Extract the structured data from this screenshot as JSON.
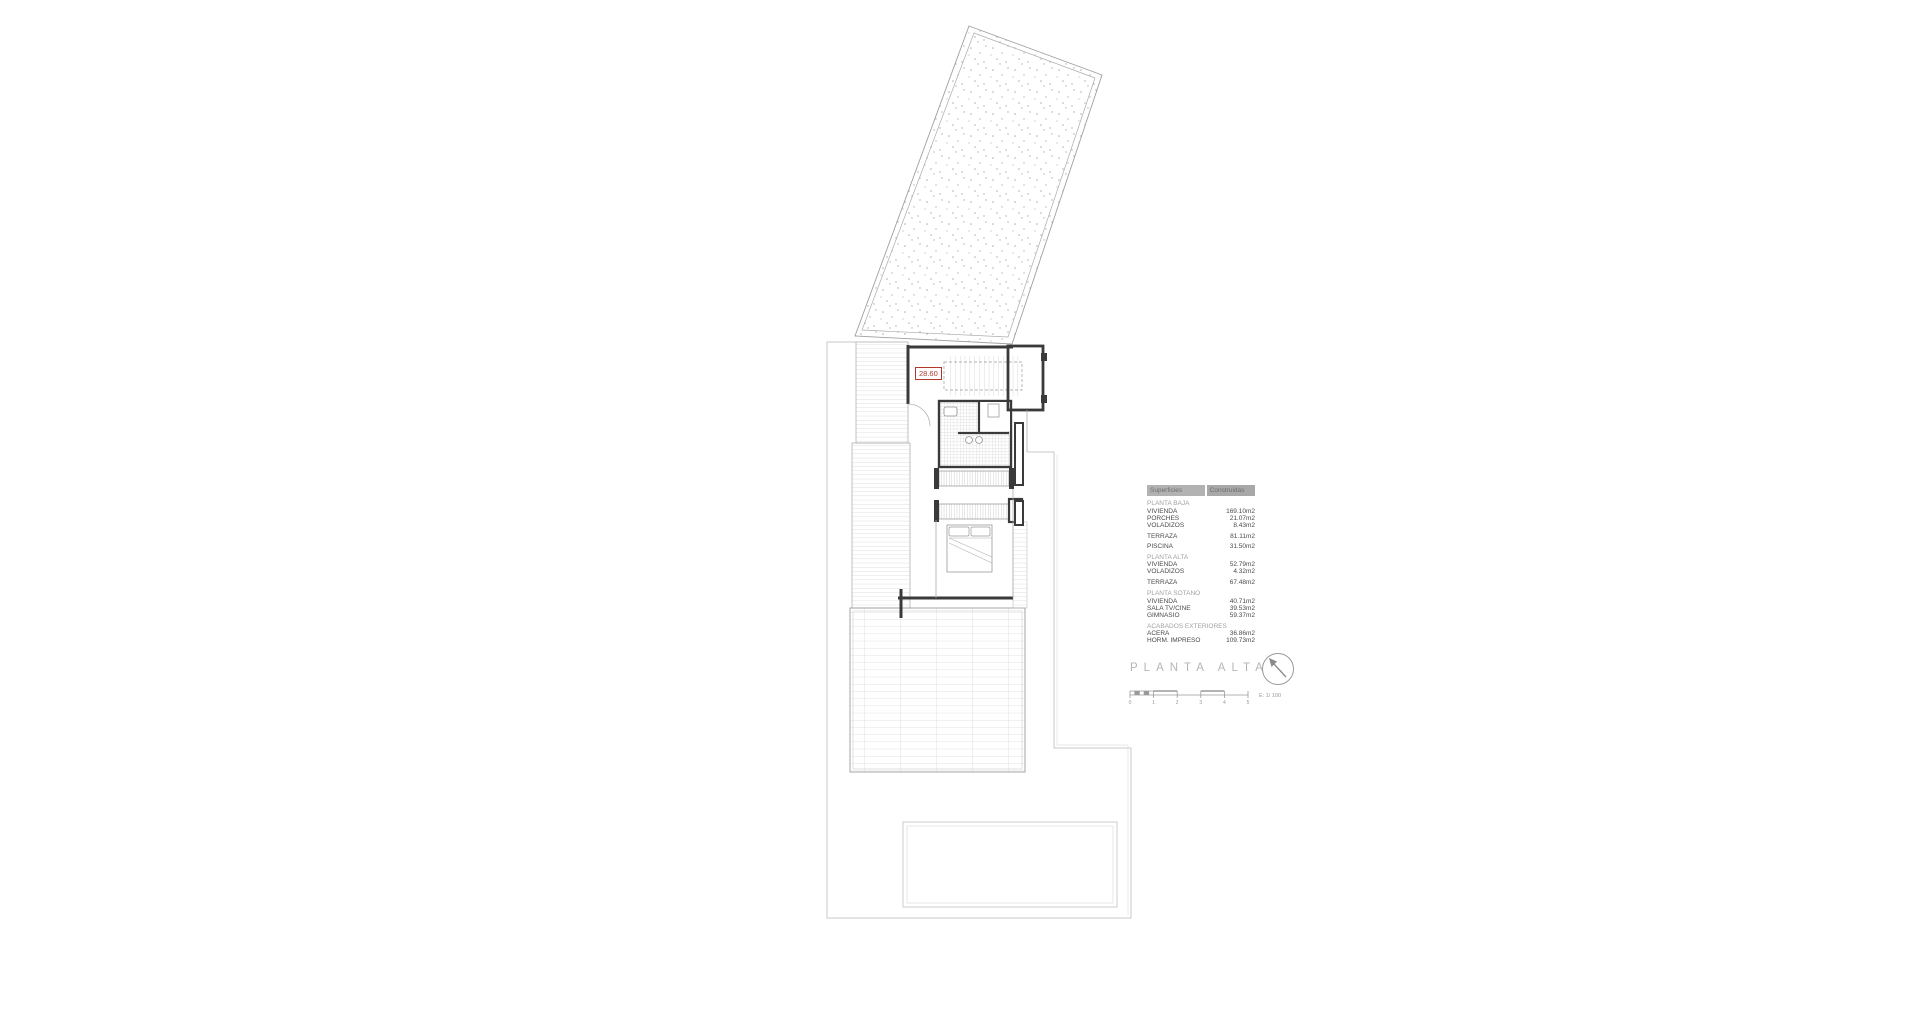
{
  "plan": {
    "level_label": "28.60",
    "colors": {
      "wall": "#3a3a3a",
      "label_red": "#b5362c",
      "hatch": "#bdbdbd",
      "boundary": "#c9c9c9",
      "table_header_bg": "#b2b2b2"
    }
  },
  "surfaces": {
    "header": {
      "col1": "Superficies",
      "col2": "Construidas"
    },
    "groups": [
      {
        "title": "PLANTA BAJA",
        "items": [
          {
            "label": "VIVIENDA",
            "value": "169.10m2"
          },
          {
            "label": "PORCHES",
            "value": "21.07m2"
          },
          {
            "label": "VOLADIZOS",
            "value": "8.43m2"
          }
        ]
      },
      {
        "title": "",
        "items": [
          {
            "label": "TERRAZA",
            "value": "81.11m2"
          },
          {
            "label": "PISCINA",
            "value": "31.50m2"
          }
        ]
      },
      {
        "title": "PLANTA ALTA",
        "items": [
          {
            "label": "VIVIENDA",
            "value": "52.79m2"
          },
          {
            "label": "VOLADIZOS",
            "value": "4.32m2"
          }
        ]
      },
      {
        "title": "",
        "items": [
          {
            "label": "TERRAZA",
            "value": "67.48m2"
          }
        ]
      },
      {
        "title": "PLANTA SOTANO",
        "items": [
          {
            "label": "VIVIENDA",
            "value": "40.71m2"
          },
          {
            "label": "SALA TV/CINE",
            "value": "39.53m2"
          },
          {
            "label": "GIMNASIO",
            "value": "59.37m2"
          }
        ]
      },
      {
        "title": "ACABADOS EXTERIORES",
        "items": [
          {
            "label": "ACERA",
            "value": "36.86m2"
          },
          {
            "label": "HORM. IMPRESO",
            "value": "109.73m2"
          }
        ]
      }
    ]
  },
  "titleblock": {
    "title": "PLANTA ALTA",
    "scale_label": "E: 1/ 100",
    "scale_ticks": [
      "0",
      "1",
      "2",
      "3",
      "4",
      "5"
    ]
  }
}
